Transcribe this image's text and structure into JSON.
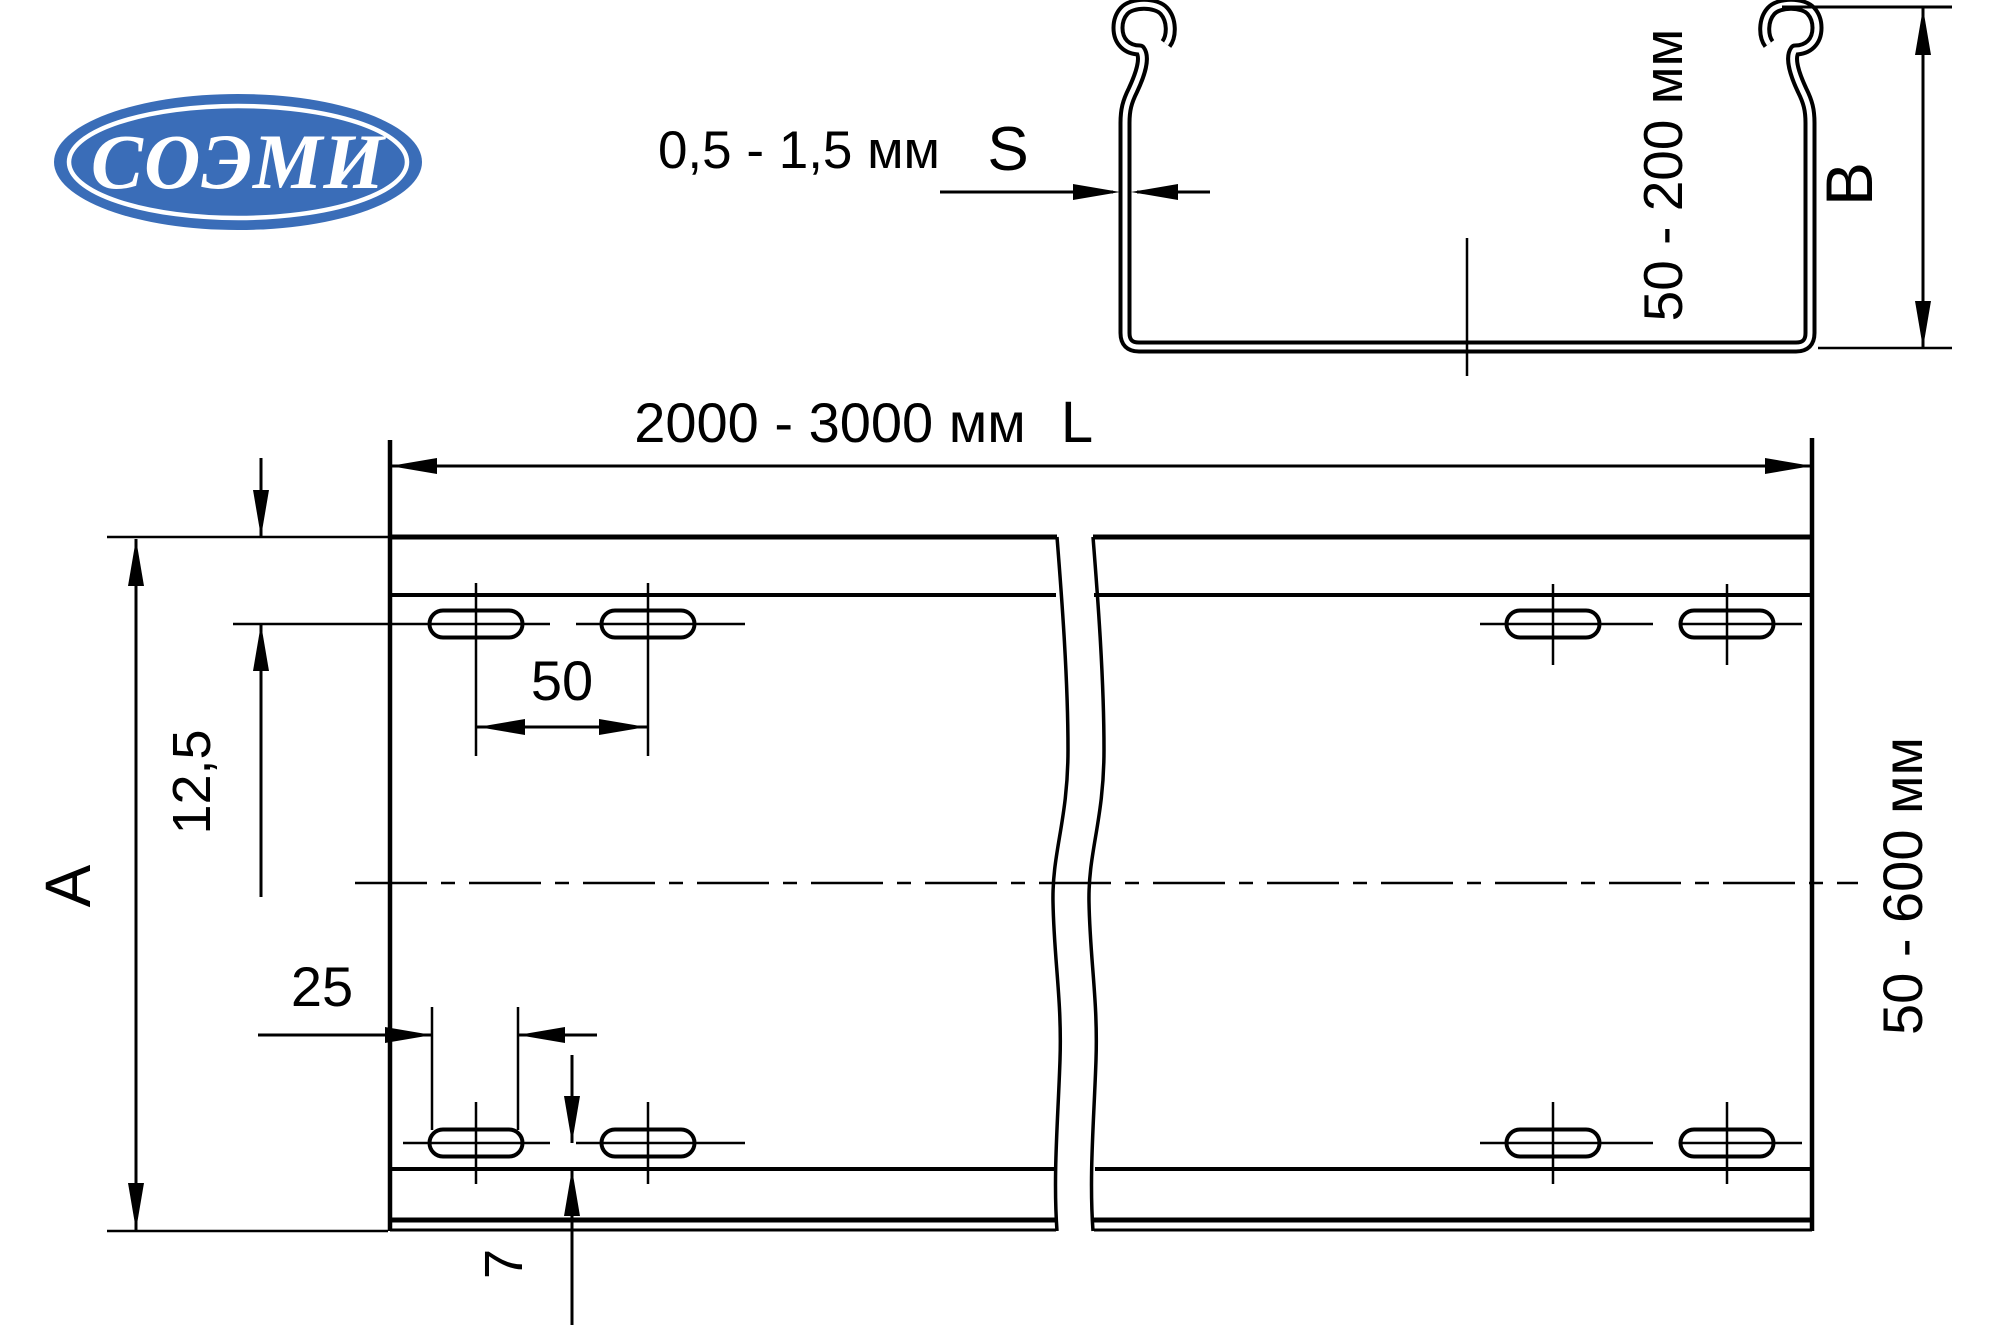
{
  "logo": {
    "text": "СОЭМИ",
    "bg_color": "#3a6db8",
    "ring_color": "#ffffff",
    "text_color": "#ffffff"
  },
  "cross_section": {
    "sheet_thickness": {
      "range": "0,5 - 1,5 мм",
      "symbol": "S"
    },
    "side_height": {
      "range": "50 - 200 мм",
      "symbol": "B"
    }
  },
  "plan_view": {
    "length": {
      "range": "2000 - 3000 мм",
      "symbol": "L"
    },
    "width": {
      "range": "50 - 600 мм",
      "symbol": "A"
    },
    "hole_row_offset": "12,5",
    "hole_spacing": "50",
    "slot_length": "25",
    "bottom_offset": "7"
  },
  "line_color": "#000000"
}
